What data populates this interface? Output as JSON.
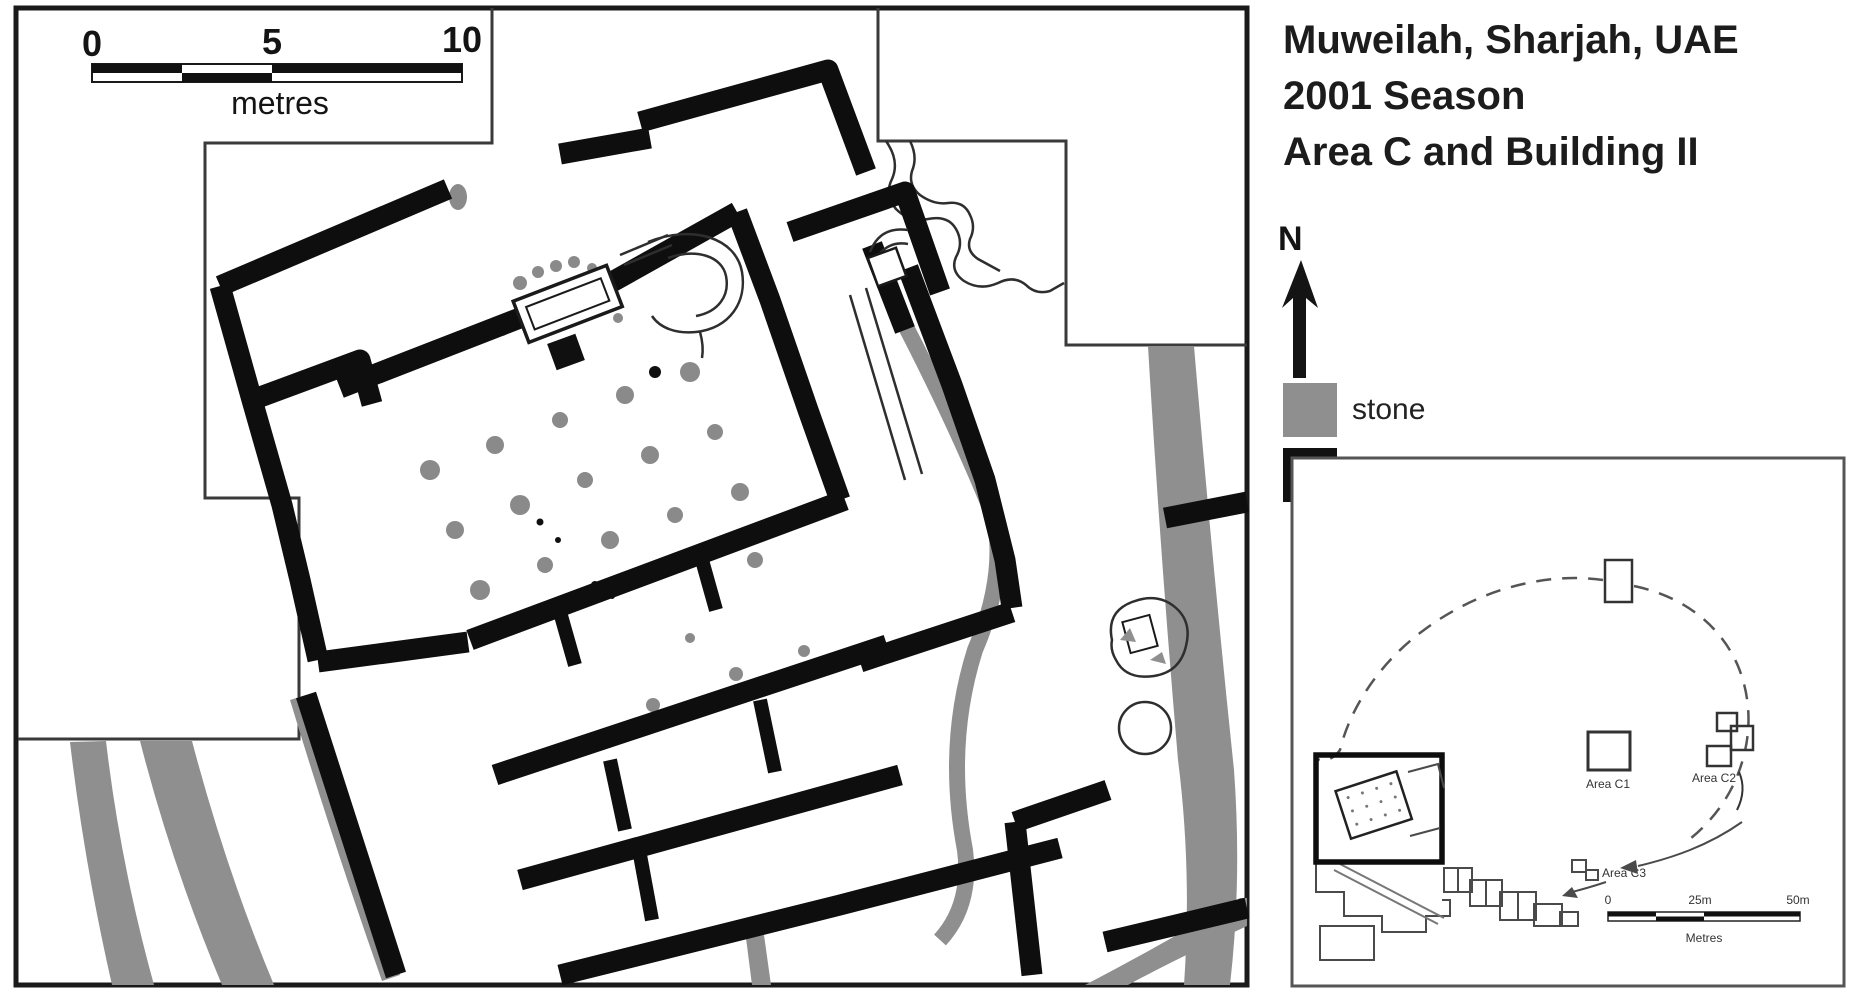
{
  "title": {
    "line1": "Muweilah, Sharjah, UAE",
    "line2": "2001 Season",
    "line3": "Area C and Building II"
  },
  "compass": {
    "label": "N"
  },
  "legend": {
    "items": [
      {
        "name": "stone",
        "label": "stone",
        "color": "#8f8f8f"
      },
      {
        "name": "pise",
        "label": "pisé",
        "color": "#111111"
      }
    ]
  },
  "main_scale_bar": {
    "tick0": "0",
    "tick5": "5",
    "tick10": "10",
    "unit": "metres"
  },
  "inset": {
    "areas": [
      {
        "label": "Area C1"
      },
      {
        "label": "Area C2"
      },
      {
        "label": "Area C3"
      }
    ],
    "scale_bar": {
      "tick0": "0",
      "tick25": "25m",
      "tick50": "50m",
      "unit": "Metres"
    }
  },
  "colors": {
    "pise": "#111111",
    "stone": "#8f8f8f",
    "background": "#ffffff",
    "line": "#1a1a1a"
  }
}
